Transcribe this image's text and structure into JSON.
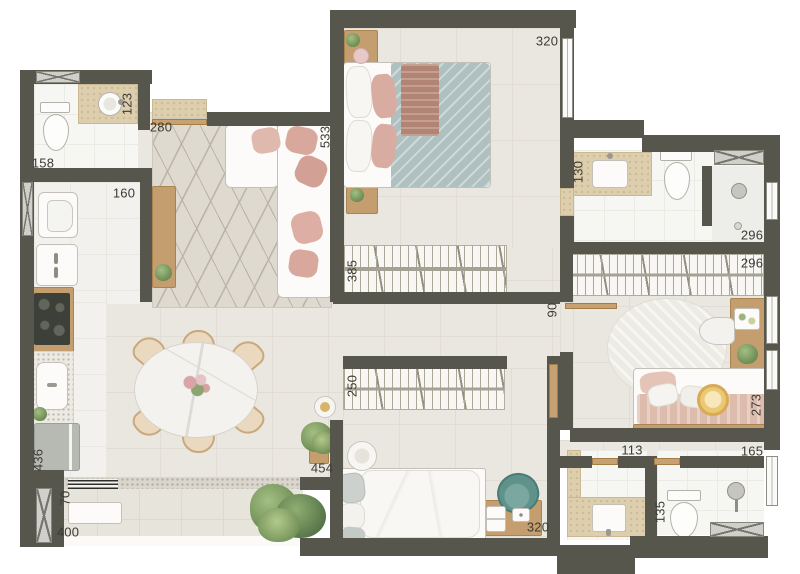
{
  "plan": {
    "type": "residential apartment floor plan",
    "unit": "cm",
    "view": "top-down furnished render"
  },
  "colors": {
    "wall": "#56564d",
    "floor_living": "#eae7e0",
    "floor_bath": "#f6f6f3",
    "floor_balcony": "#e7e4db",
    "travertine_counter": "#ddcfae",
    "wood": "#c49e6e",
    "pillow_pink": "#d8a89d",
    "blanket_teal": "#adbfbe",
    "chair_teal": "#5f928b",
    "plant_green": "#6b9356",
    "lion_plush_yellow": "#eac874"
  },
  "dimensions": {
    "master_width": "320",
    "lavabo_vanity": "123",
    "entry_width": "280",
    "living_length": "533",
    "lavabo_width": "158",
    "kitchen_width": "160",
    "master_closet": "385",
    "ensuite_vanity": "130",
    "ensuite_length": "296",
    "kids_closet": "296",
    "hall_width": "90",
    "bed2_closet": "250",
    "kids_bed_wall": "273",
    "bath_social_width": "113",
    "bath2_width": "165",
    "kitchen_run": "436",
    "balcony_pillar": "70",
    "balcony_length": "400",
    "living_width": "454",
    "bed2_wall": "320",
    "bath_social_length": "135"
  }
}
